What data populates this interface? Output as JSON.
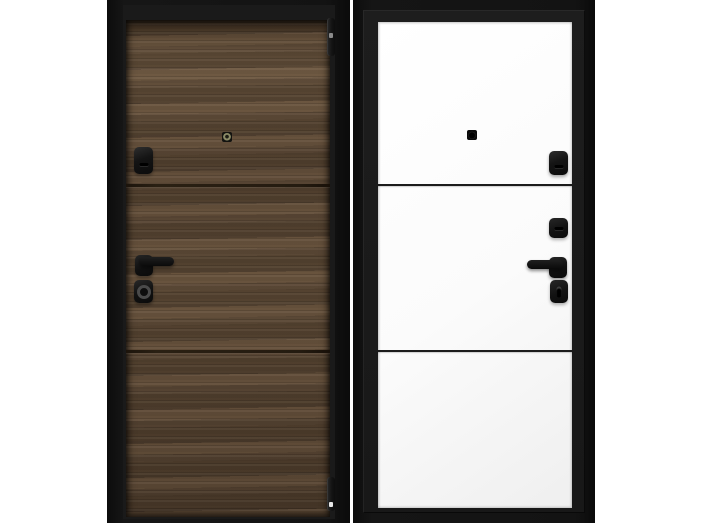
{
  "scene": {
    "kind": "product-photo",
    "subject": "steel entry door shown from both sides",
    "left_view": "exterior side, dark walnut wood finish, three horizontal sections, black hardware, two hinges on right edge",
    "right_view": "interior side, white finish, three horizontal sections, black hardware on right"
  },
  "colors": {
    "background": "#ffffff",
    "frame_black": "#121212",
    "frame_inner": "#1a1a1a",
    "wood_base": "#5d4a38",
    "wood_dark": "#433426",
    "wood_light": "#6f5a44",
    "seam_dark": "#241b10",
    "panel_white": "#fbfbfb",
    "panel_shade": "#efefef",
    "hardware_black": "#141414",
    "hardware_highlight": "#2e2e2e",
    "metal_ring": "#4a4a4a",
    "lens_olive": "#8a8a66",
    "hinge_notch": "#e6e6e6",
    "white_seam": "#1c1c1c"
  },
  "exterior_door": {
    "sections": 3,
    "hardware": [
      "peephole",
      "lock escutcheon",
      "lever handle",
      "cylinder escutcheon",
      "top hinge",
      "bottom hinge"
    ]
  },
  "interior_door": {
    "sections": 3,
    "hardware": [
      "peephole",
      "lock escutcheon",
      "latch escutcheon",
      "lever handle",
      "thumbturn escutcheon"
    ]
  }
}
